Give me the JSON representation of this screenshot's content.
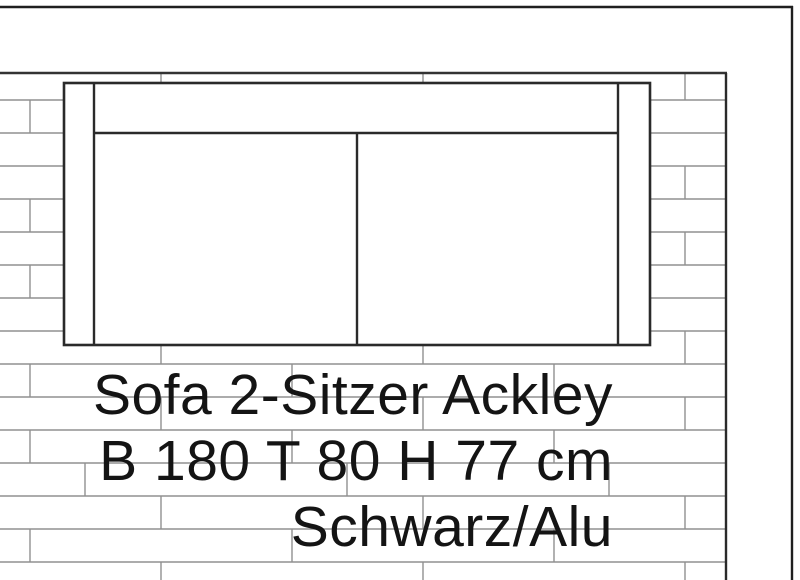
{
  "drawing": {
    "annotation": {
      "line1": "Sofa 2-Sitzer Ackley",
      "line2": "B 180 T 80 H 77 cm",
      "line3": "Schwarz/Alu"
    },
    "colors": {
      "outline_dark": "#2a2a2a",
      "hatch_gray": "#909090",
      "text": "#141414",
      "background": "#ffffff"
    }
  }
}
